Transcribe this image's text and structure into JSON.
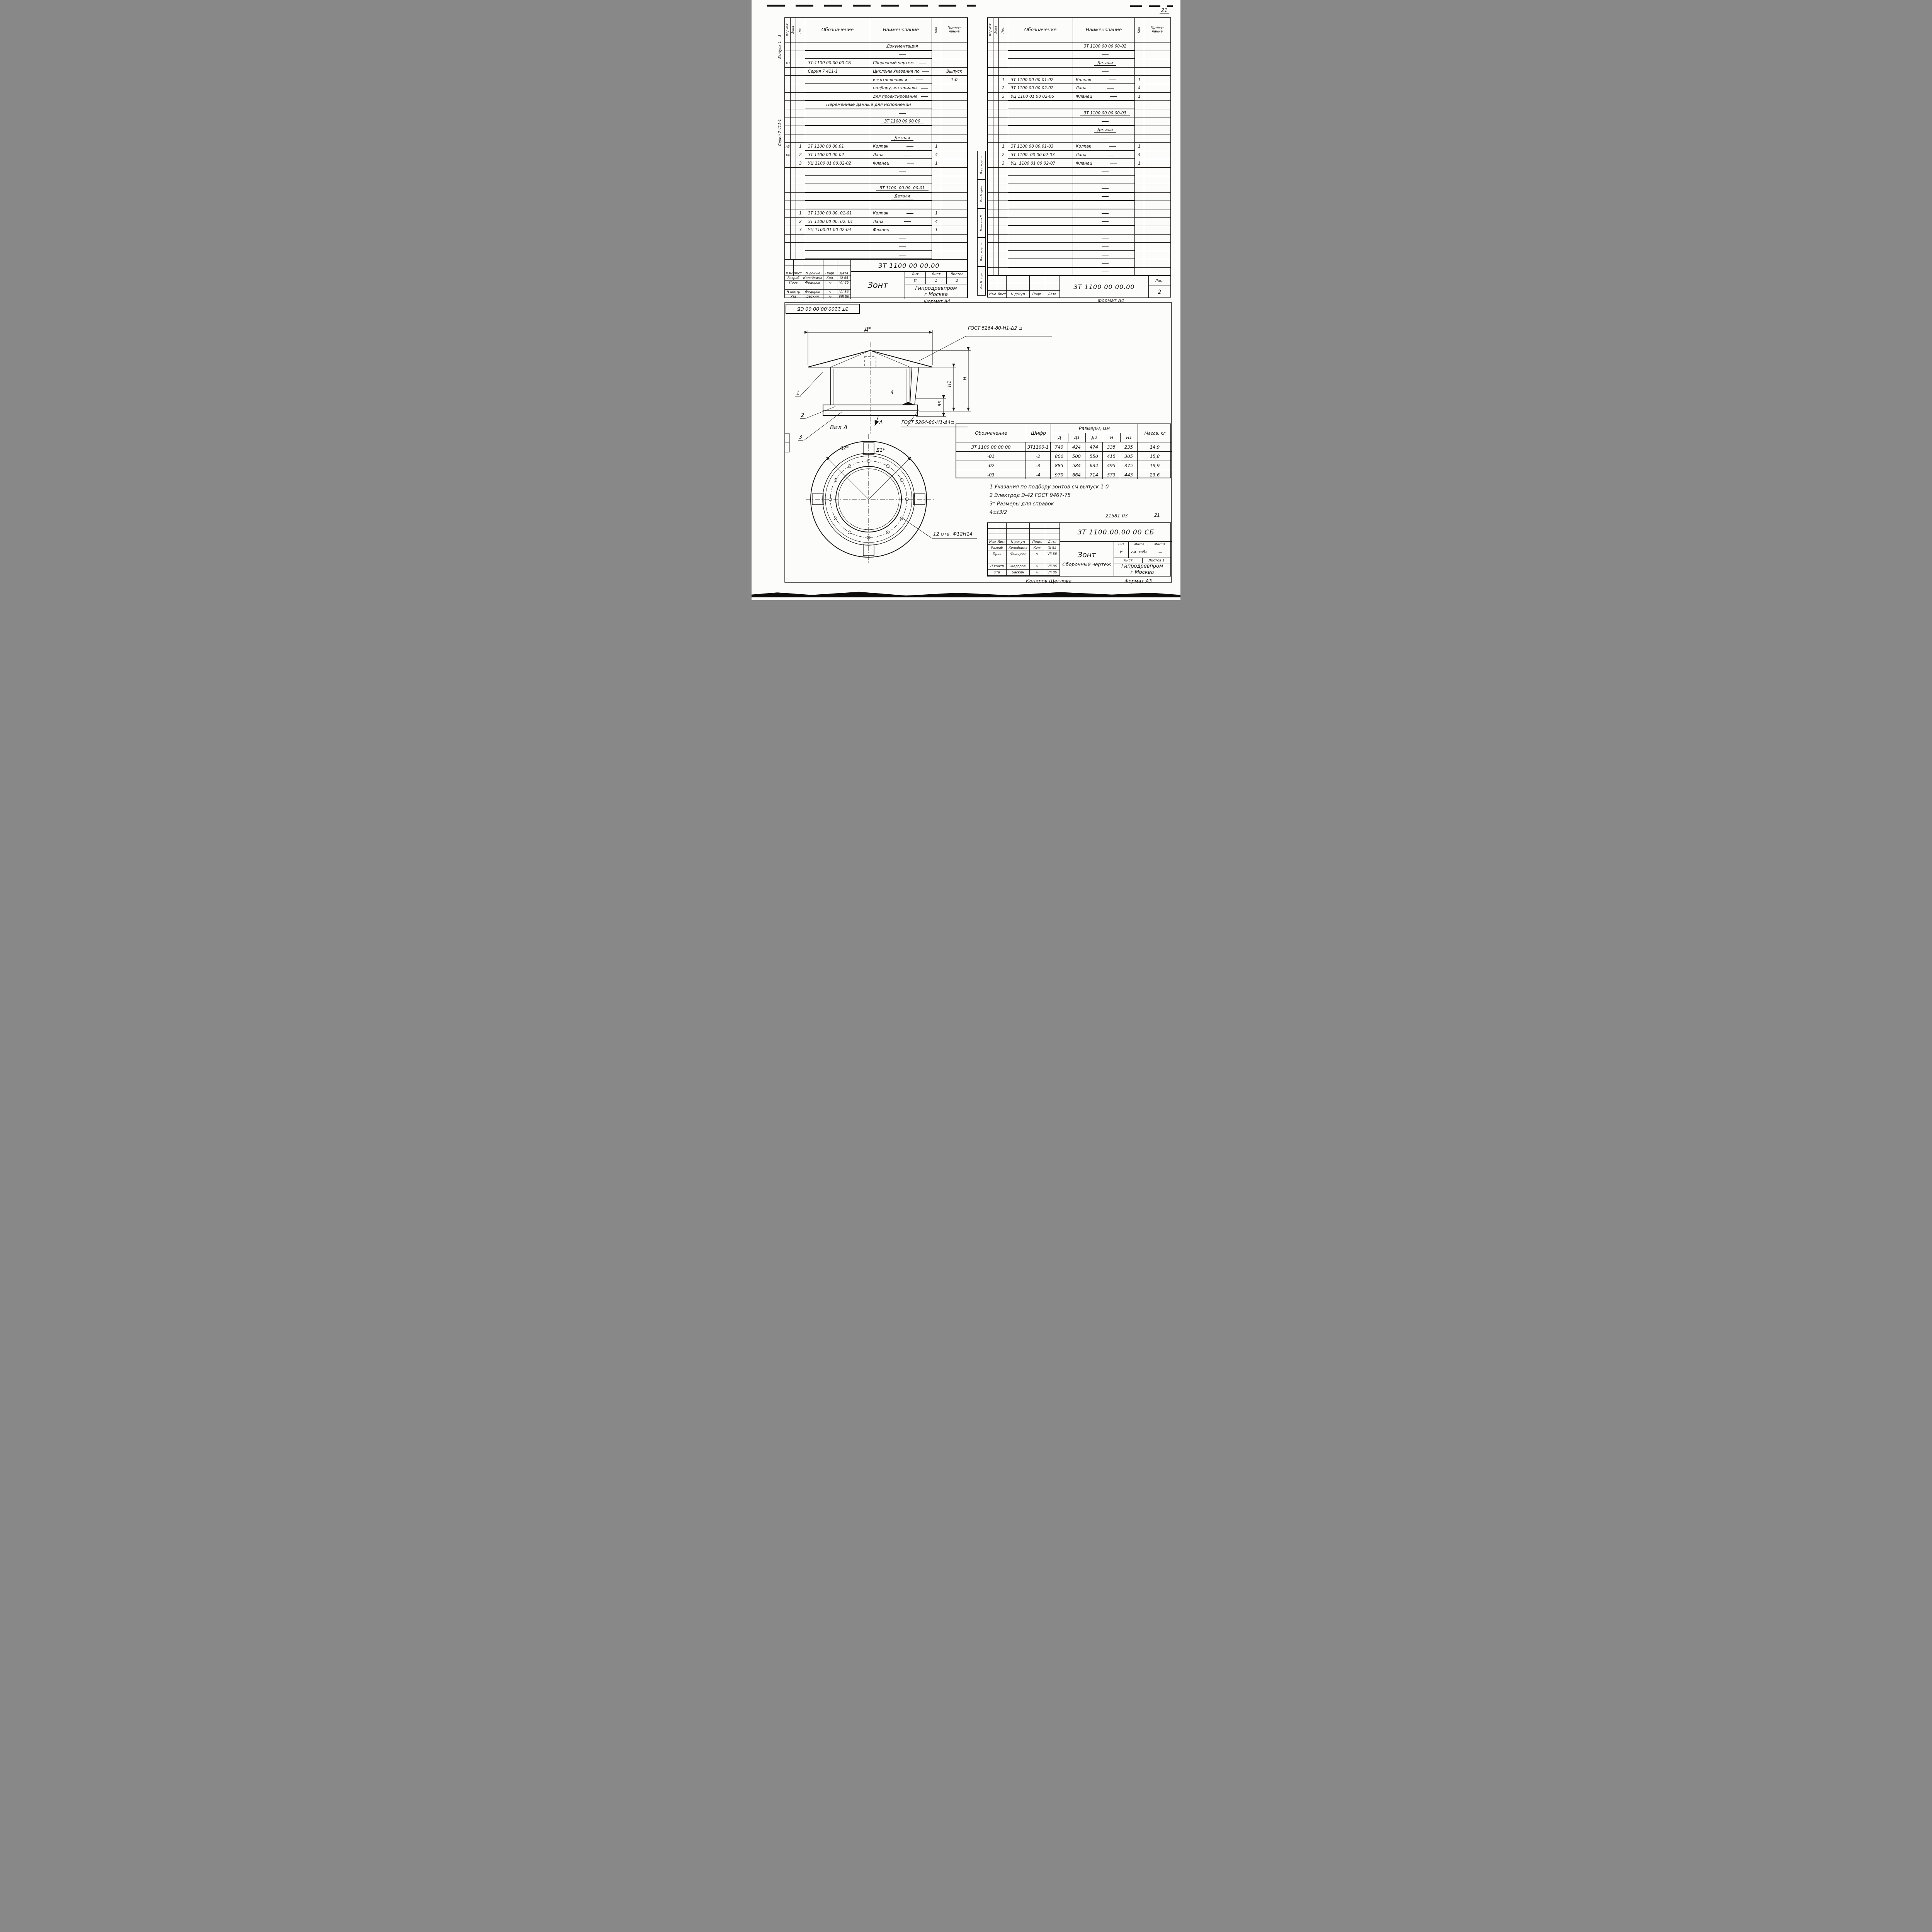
{
  "page": {
    "number": "21",
    "corner_stamp": "ЗТ 1100.00.00 00 СБ",
    "copy_note": "Копиров  Щеглова",
    "format_a3": "Формат А3",
    "format_a4_left": "Формат А4",
    "format_a4_right": "Формат А4",
    "doc_small_1": "21581-03",
    "doc_small_2": "21"
  },
  "margin": {
    "issue": "Выпуск 1 – 3",
    "series": "Серия 7 411-1",
    "stamps": [
      "Подп и дата",
      "Инв N дубл",
      "Взам инв N",
      "Подп и дата",
      "Инв N подл"
    ]
  },
  "spec_header": {
    "format": "Формат",
    "zone": "Зона",
    "pos": "Поз.",
    "designation": "Обозначение",
    "name": "Наименование",
    "qty": "Кол",
    "note": "Приме- чание"
  },
  "sig_cols": {
    "izm": "Изм",
    "list": "Лист",
    "doc": "N докум",
    "sign": "Подп.",
    "date": "Дата"
  },
  "left_table": {
    "rows": [
      {
        "f": "",
        "z": "",
        "p": "",
        "d": "",
        "n": "",
        "nu": "Документация",
        "wide": "",
        "q": "",
        "r": ""
      },
      {
        "f": "",
        "z": "",
        "p": "",
        "d": "",
        "n": "",
        "nu": "",
        "wide": "",
        "q": "",
        "r": ""
      },
      {
        "f": "А3",
        "z": "",
        "p": "",
        "d": "ЗТ-1100 00.00 00 СБ",
        "n": "Сборочный чертеж",
        "nu": "",
        "wide": "",
        "q": "",
        "r": ""
      },
      {
        "f": "",
        "z": "",
        "p": "",
        "d": "Серия 7  411-1",
        "n": "Циклоны Указания по",
        "nu": "",
        "wide": "",
        "q": "",
        "r": "Выпуск"
      },
      {
        "f": "",
        "z": "",
        "p": "",
        "d": "",
        "n": "изготовлению и",
        "nu": "",
        "wide": "",
        "q": "",
        "r": "1-0"
      },
      {
        "f": "",
        "z": "",
        "p": "",
        "d": "",
        "n": "подбору, материалы",
        "nu": "",
        "wide": "",
        "q": "",
        "r": ""
      },
      {
        "f": "",
        "z": "",
        "p": "",
        "d": "",
        "n": "для проектирования",
        "nu": "",
        "wide": "",
        "q": "",
        "r": ""
      },
      {
        "f": "",
        "z": "",
        "p": "",
        "d": "",
        "n": "",
        "nu": "",
        "wide": "Переменные  данные  для  исполнений",
        "q": "",
        "r": ""
      },
      {
        "f": "",
        "z": "",
        "p": "",
        "d": "",
        "n": "",
        "nu": "",
        "wide": "",
        "q": "",
        "r": ""
      },
      {
        "f": "",
        "z": "",
        "p": "",
        "d": "",
        "n": "",
        "nu": "ЗТ 1100 00 00 00",
        "wide": "",
        "q": "",
        "r": ""
      },
      {
        "f": "",
        "z": "",
        "p": "",
        "d": "",
        "n": "",
        "nu": "",
        "wide": "",
        "q": "",
        "r": ""
      },
      {
        "f": "",
        "z": "",
        "p": "",
        "d": "",
        "n": "",
        "nu": "Детали",
        "wide": "",
        "q": "",
        "r": ""
      },
      {
        "f": "А3",
        "z": "",
        "p": "1",
        "d": "ЗТ 1100 00 00.01",
        "n": "Колпак",
        "nu": "",
        "wide": "",
        "q": "1",
        "r": ""
      },
      {
        "f": "А4",
        "z": "",
        "p": "2",
        "d": "ЗТ 1100 00 00 02",
        "n": "Лапа",
        "nu": "",
        "wide": "",
        "q": "4",
        "r": ""
      },
      {
        "f": "",
        "z": "",
        "p": "3",
        "d": "УЦ 1100 01 00.02-02",
        "n": "Фланец",
        "nu": "",
        "wide": "",
        "q": "1",
        "r": ""
      },
      {
        "f": "",
        "z": "",
        "p": "",
        "d": "",
        "n": "",
        "nu": "",
        "wide": "",
        "q": "",
        "r": ""
      },
      {
        "f": "",
        "z": "",
        "p": "",
        "d": "",
        "n": "",
        "nu": "",
        "wide": "",
        "q": "",
        "r": ""
      },
      {
        "f": "",
        "z": "",
        "p": "",
        "d": "",
        "n": "",
        "nu": "ЗТ 1100. 00.00. 00-01",
        "wide": "",
        "q": "",
        "r": ""
      },
      {
        "f": "",
        "z": "",
        "p": "",
        "d": "",
        "n": "",
        "nu": "Детали",
        "wide": "",
        "q": "",
        "r": ""
      },
      {
        "f": "",
        "z": "",
        "p": "",
        "d": "",
        "n": "",
        "nu": "",
        "wide": "",
        "q": "",
        "r": ""
      },
      {
        "f": "",
        "z": "",
        "p": "1",
        "d": "ЗТ 1100 00 00. 01-01",
        "n": "Колпак",
        "nu": "",
        "wide": "",
        "q": "1",
        "r": ""
      },
      {
        "f": "",
        "z": "",
        "p": "2",
        "d": "ЗТ 1100 00 00. 02. 01",
        "n": "Лапа",
        "nu": "",
        "wide": "",
        "q": "4",
        "r": ""
      },
      {
        "f": "",
        "z": "",
        "p": "3",
        "d": "УЦ 1100.01 00 02-04",
        "n": "Фланец",
        "nu": "",
        "wide": "",
        "q": "1",
        "r": ""
      },
      {
        "f": "",
        "z": "",
        "p": "",
        "d": "",
        "n": "",
        "nu": "",
        "wide": "",
        "q": "",
        "r": ""
      },
      {
        "f": "",
        "z": "",
        "p": "",
        "d": "",
        "n": "",
        "nu": "",
        "wide": "",
        "q": "",
        "r": ""
      },
      {
        "f": "",
        "z": "",
        "p": "",
        "d": "",
        "n": "",
        "nu": "",
        "wide": "",
        "q": "",
        "r": ""
      }
    ]
  },
  "right_table": {
    "rows": [
      {
        "f": "",
        "z": "",
        "p": "",
        "d": "",
        "n": "",
        "nu": "ЗТ 1100 00 00 00-02",
        "wide": "",
        "q": "",
        "r": ""
      },
      {
        "f": "",
        "z": "",
        "p": "",
        "d": "",
        "n": "",
        "nu": "",
        "wide": "",
        "q": "",
        "r": ""
      },
      {
        "f": "",
        "z": "",
        "p": "",
        "d": "",
        "n": "",
        "nu": "Детали",
        "wide": "",
        "q": "",
        "r": ""
      },
      {
        "f": "",
        "z": "",
        "p": "",
        "d": "",
        "n": "",
        "nu": "",
        "wide": "",
        "q": "",
        "r": ""
      },
      {
        "f": "",
        "z": "",
        "p": "1",
        "d": "ЗТ 1100 00 00 01-02",
        "n": "Колпак",
        "nu": "",
        "wide": "",
        "q": "1",
        "r": ""
      },
      {
        "f": "",
        "z": "",
        "p": "2",
        "d": "ЗТ 1100 00 00 02-02",
        "n": "Лапа",
        "nu": "",
        "wide": "",
        "q": "4",
        "r": ""
      },
      {
        "f": "",
        "z": "",
        "p": "3",
        "d": "УЦ 1100 01 00 02-06",
        "n": "Фланец",
        "nu": "",
        "wide": "",
        "q": "1",
        "r": ""
      },
      {
        "f": "",
        "z": "",
        "p": "",
        "d": "",
        "n": "",
        "nu": "",
        "wide": "",
        "q": "",
        "r": ""
      },
      {
        "f": "",
        "z": "",
        "p": "",
        "d": "",
        "n": "",
        "nu": "ЗТ 1100.00.00.00-03",
        "wide": "",
        "q": "",
        "r": ""
      },
      {
        "f": "",
        "z": "",
        "p": "",
        "d": "",
        "n": "",
        "nu": "",
        "wide": "",
        "q": "",
        "r": ""
      },
      {
        "f": "",
        "z": "",
        "p": "",
        "d": "",
        "n": "",
        "nu": "Детали",
        "wide": "",
        "q": "",
        "r": ""
      },
      {
        "f": "",
        "z": "",
        "p": "",
        "d": "",
        "n": "",
        "nu": "",
        "wide": "",
        "q": "",
        "r": ""
      },
      {
        "f": "",
        "z": "",
        "p": "1",
        "d": "ЗТ 1100 00 00.01-03",
        "n": "Колпак",
        "nu": "",
        "wide": "",
        "q": "1",
        "r": ""
      },
      {
        "f": "",
        "z": "",
        "p": "2",
        "d": "ЗТ 1100. 00 00 02-03",
        "n": "Лапа",
        "nu": "",
        "wide": "",
        "q": "4",
        "r": ""
      },
      {
        "f": "",
        "z": "",
        "p": "3",
        "d": "УЦ. 1100 01 00 02-07",
        "n": "Фланец",
        "nu": "",
        "wide": "",
        "q": "1",
        "r": ""
      },
      {
        "f": "",
        "z": "",
        "p": "",
        "d": "",
        "n": "",
        "nu": "",
        "wide": "",
        "q": "",
        "r": ""
      },
      {
        "f": "",
        "z": "",
        "p": "",
        "d": "",
        "n": "",
        "nu": "",
        "wide": "",
        "q": "",
        "r": ""
      },
      {
        "f": "",
        "z": "",
        "p": "",
        "d": "",
        "n": "",
        "nu": "",
        "wide": "",
        "q": "",
        "r": ""
      },
      {
        "f": "",
        "z": "",
        "p": "",
        "d": "",
        "n": "",
        "nu": "",
        "wide": "",
        "q": "",
        "r": ""
      },
      {
        "f": "",
        "z": "",
        "p": "",
        "d": "",
        "n": "",
        "nu": "",
        "wide": "",
        "q": "",
        "r": ""
      },
      {
        "f": "",
        "z": "",
        "p": "",
        "d": "",
        "n": "",
        "nu": "",
        "wide": "",
        "q": "",
        "r": ""
      },
      {
        "f": "",
        "z": "",
        "p": "",
        "d": "",
        "n": "",
        "nu": "",
        "wide": "",
        "q": "",
        "r": ""
      },
      {
        "f": "",
        "z": "",
        "p": "",
        "d": "",
        "n": "",
        "nu": "",
        "wide": "",
        "q": "",
        "r": ""
      },
      {
        "f": "",
        "z": "",
        "p": "",
        "d": "",
        "n": "",
        "nu": "",
        "wide": "",
        "q": "",
        "r": ""
      },
      {
        "f": "",
        "z": "",
        "p": "",
        "d": "",
        "n": "",
        "nu": "",
        "wide": "",
        "q": "",
        "r": ""
      },
      {
        "f": "",
        "z": "",
        "p": "",
        "d": "",
        "n": "",
        "nu": "",
        "wide": "",
        "q": "",
        "r": ""
      },
      {
        "f": "",
        "z": "",
        "p": "",
        "d": "",
        "n": "",
        "nu": "",
        "wide": "",
        "q": "",
        "r": ""
      },
      {
        "f": "",
        "z": "",
        "p": "",
        "d": "",
        "n": "",
        "nu": "",
        "wide": "",
        "q": "",
        "r": ""
      }
    ]
  },
  "left_block": {
    "doc_number": "ЗТ 1100 00 00.00",
    "title": "Зонт",
    "rows": [
      {
        "role": "Разраб",
        "name": "Колейкина",
        "sig": "Кол-",
        "date": "XI 85"
      },
      {
        "role": "Пров",
        "name": "Федоров",
        "sig": "∿",
        "date": "VII 86"
      },
      {
        "role": "",
        "name": "",
        "sig": "",
        "date": ""
      },
      {
        "role": "Н контр",
        "name": "Федоров",
        "sig": "∿",
        "date": "VII 86"
      },
      {
        "role": "Утв",
        "name": "Баскин",
        "sig": "∿",
        "date": "VIII 86"
      }
    ],
    "lit_label": "Лит",
    "list_label": "Лист",
    "listov_label": "Листов",
    "lit": "И",
    "list_val": "1",
    "listov_val": "2",
    "org1": "Гипродревпром",
    "org2": "г Москва"
  },
  "right_block": {
    "doc_number": "ЗТ 1100 00 00.00",
    "list_label": "Лист",
    "list_val": "2"
  },
  "drawing": {
    "weld_top": "ГОСТ 5264-80-Н1-Δ2  ⊐",
    "weld_bottom": "ГОСТ 5264-80-Н1-Δ4⊐",
    "weld_qty": "4",
    "dim_d": "Д*",
    "dim_h": "Н",
    "dim_h1": "Н1",
    "dim_55": "55",
    "view_label": "Вид А",
    "view_arrow": "А",
    "holes_label": "12 отв. Ф12Н14",
    "d1_label": "Д1*",
    "d2_label": "Д2*",
    "callout_1": "1",
    "callout_2": "2",
    "callout_3": "3"
  },
  "dim_table": {
    "col_designation": "Обозначение",
    "col_code": "Шифр",
    "col_sizes": "Размеры, мм",
    "col_mass": "Масса, кг",
    "size_cols": [
      "Д",
      "Д1",
      "Д2",
      "Н",
      "Н1"
    ],
    "rows": [
      {
        "designation": "ЗТ  1100 00 00 00",
        "code": "ЗТ1100-1",
        "d": "740",
        "d1": "424",
        "d2": "474",
        "h": "335",
        "h1": "235",
        "mass": "14,9"
      },
      {
        "designation": "-01",
        "code": "-2",
        "d": "800",
        "d1": "500",
        "d2": "550",
        "h": "415",
        "h1": "305",
        "mass": "15,8"
      },
      {
        "designation": "-02",
        "code": "-3",
        "d": "885",
        "d1": "584",
        "d2": "634",
        "h": "495",
        "h1": "375",
        "mass": "19,9"
      },
      {
        "designation": "-03",
        "code": "-4",
        "d": "970",
        "d1": "664",
        "d2": "714",
        "h": "573",
        "h1": "443",
        "mass": "23,6"
      }
    ]
  },
  "notes": [
    "1  Указания по подбору зонтов см выпуск 1-0",
    "2  Электрод  Э-42  ГОСТ 9467-75",
    "3* Размеры для  справок",
    "4±t3/2"
  ],
  "bottom_block": {
    "doc_number": "ЗТ 1100.00.00 00 СБ",
    "title": "Зонт",
    "subtitle": "Сборочный чертеж",
    "rows": [
      {
        "role": "Разраб",
        "name": "Колейкина",
        "sig": "Кол-",
        "date": "XI 85"
      },
      {
        "role": "Пров",
        "name": "Федоров",
        "sig": "∿",
        "date": "VII 86"
      },
      {
        "role": "",
        "name": "",
        "sig": "",
        "date": ""
      },
      {
        "role": "Н контр",
        "name": "Федоров",
        "sig": "∿",
        "date": "VII 86"
      },
      {
        "role": "Утв",
        "name": "Баскин",
        "sig": "∿",
        "date": "VII 86"
      }
    ],
    "lit_label": "Лит",
    "mass_label": "Масса",
    "scale_label": "Масшт.",
    "lit": "И",
    "mass": "см. табл",
    "scale": "—",
    "sheet_label": "Лист",
    "sheets_label": "Листов 1",
    "org1": "Гипродревпром",
    "org2": "г Москва"
  }
}
